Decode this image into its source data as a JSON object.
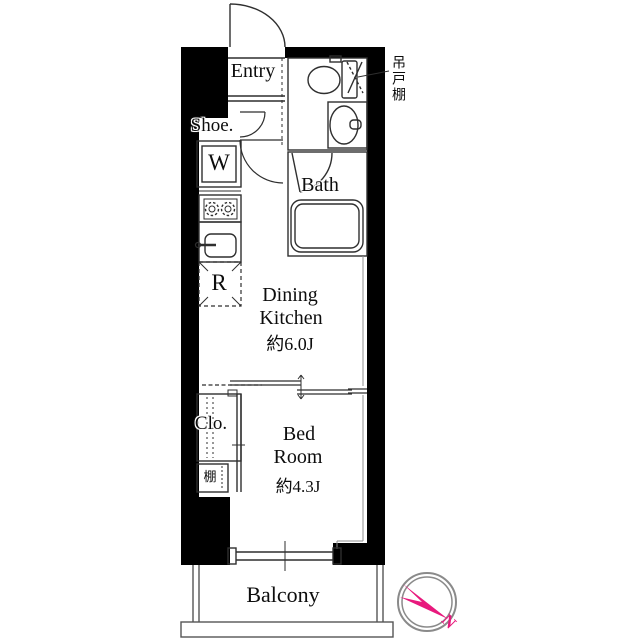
{
  "floor_plan": {
    "rooms": {
      "entry": {
        "label": "Entry"
      },
      "bath": {
        "label": "Bath"
      },
      "dining_kitchen": {
        "line1": "Dining",
        "line2": "Kitchen",
        "size": "約6.0J"
      },
      "bedroom": {
        "line1": "Bed",
        "line2": "Room",
        "size": "約4.3J"
      },
      "balcony": {
        "label": "Balcony"
      }
    },
    "fixtures": {
      "shoe_cabinet": {
        "label": "Shoe."
      },
      "washing_machine": {
        "label": "W"
      },
      "refrigerator": {
        "label": "R"
      },
      "closet": {
        "label": "Clo."
      },
      "shelf": {
        "label": "棚"
      },
      "hanging_cupboard": {
        "label": "吊戸棚"
      }
    },
    "compass": {
      "north": "N"
    },
    "colors": {
      "wall": "#000000",
      "line": "#2f2f2f",
      "accent_pink": "#e8197d",
      "compass_ring": "#8a8a8a"
    }
  }
}
